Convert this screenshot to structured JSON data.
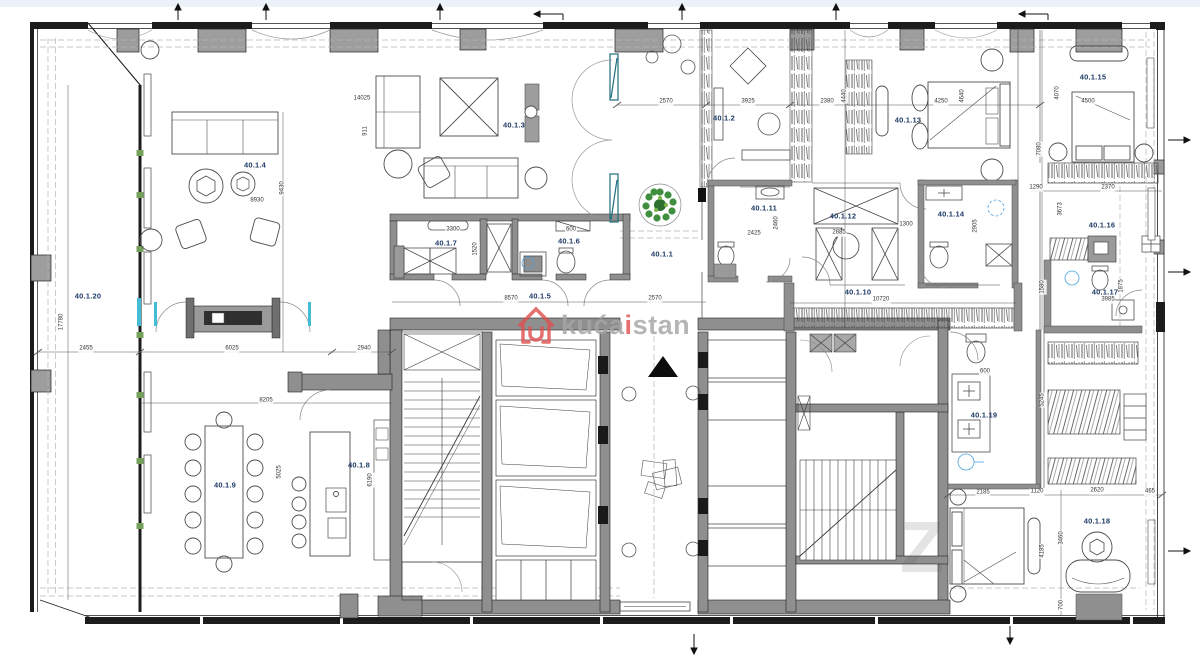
{
  "plan": {
    "type": "apartment-floor-plan",
    "unit_prefix": "40.1",
    "rooms": [
      {
        "label": "40.1.1",
        "x": 662,
        "y": 254
      },
      {
        "label": "40.1.2",
        "x": 724,
        "y": 118
      },
      {
        "label": "40.1.3",
        "x": 514,
        "y": 125
      },
      {
        "label": "40.1.4",
        "x": 255,
        "y": 165
      },
      {
        "label": "40.1.5",
        "x": 540,
        "y": 296
      },
      {
        "label": "40.1.6",
        "x": 569,
        "y": 241
      },
      {
        "label": "40.1.7",
        "x": 446,
        "y": 243
      },
      {
        "label": "40.1.8",
        "x": 359,
        "y": 465
      },
      {
        "label": "40.1.9",
        "x": 225,
        "y": 485
      },
      {
        "label": "40.1.10",
        "x": 858,
        "y": 292
      },
      {
        "label": "40.1.11",
        "x": 764,
        "y": 208
      },
      {
        "label": "40.1.12",
        "x": 843,
        "y": 216
      },
      {
        "label": "40.1.13",
        "x": 908,
        "y": 120
      },
      {
        "label": "40.1.14",
        "x": 951,
        "y": 214
      },
      {
        "label": "40.1.15",
        "x": 1093,
        "y": 77
      },
      {
        "label": "40.1.16",
        "x": 1102,
        "y": 225
      },
      {
        "label": "40.1.17",
        "x": 1105,
        "y": 292
      },
      {
        "label": "40.1.18",
        "x": 1097,
        "y": 521
      },
      {
        "label": "40.1.19",
        "x": 984,
        "y": 415
      },
      {
        "label": "40.1.20",
        "x": 88,
        "y": 296
      }
    ],
    "dimensions_mm": [
      {
        "text": "14025",
        "x": 362,
        "y": 99,
        "rot": 0
      },
      {
        "text": "911",
        "x": 366,
        "y": 131,
        "rot": 90
      },
      {
        "text": "9430",
        "x": 283,
        "y": 188,
        "rot": 90
      },
      {
        "text": "8930",
        "x": 257,
        "y": 201,
        "rot": 0
      },
      {
        "text": "17780",
        "x": 62,
        "y": 322,
        "rot": 90
      },
      {
        "text": "2455",
        "x": 86,
        "y": 349,
        "rot": 0
      },
      {
        "text": "6025",
        "x": 232,
        "y": 349,
        "rot": 0
      },
      {
        "text": "2940",
        "x": 364,
        "y": 349,
        "rot": 0
      },
      {
        "text": "8205",
        "x": 266,
        "y": 401,
        "rot": 0
      },
      {
        "text": "5025",
        "x": 280,
        "y": 472,
        "rot": 90
      },
      {
        "text": "6190",
        "x": 371,
        "y": 480,
        "rot": 90
      },
      {
        "text": "3300",
        "x": 453,
        "y": 230,
        "rot": 0
      },
      {
        "text": "600",
        "x": 571,
        "y": 230,
        "rot": 0
      },
      {
        "text": "1520",
        "x": 476,
        "y": 249,
        "rot": 90
      },
      {
        "text": "8570",
        "x": 511,
        "y": 299,
        "rot": 0
      },
      {
        "text": "2570",
        "x": 655,
        "y": 299,
        "rot": 0
      },
      {
        "text": "2570",
        "x": 666,
        "y": 102,
        "rot": 0
      },
      {
        "text": "3925",
        "x": 748,
        "y": 102,
        "rot": 0
      },
      {
        "text": "2380",
        "x": 827,
        "y": 102,
        "rot": 0
      },
      {
        "text": "4440",
        "x": 845,
        "y": 96,
        "rot": 90
      },
      {
        "text": "4250",
        "x": 941,
        "y": 102,
        "rot": 0
      },
      {
        "text": "4640",
        "x": 963,
        "y": 96,
        "rot": 90
      },
      {
        "text": "2425",
        "x": 754,
        "y": 234,
        "rot": 0
      },
      {
        "text": "2460",
        "x": 777,
        "y": 223,
        "rot": 90
      },
      {
        "text": "2885",
        "x": 839,
        "y": 233,
        "rot": 0
      },
      {
        "text": "1300",
        "x": 906,
        "y": 225,
        "rot": 0
      },
      {
        "text": "2905",
        "x": 976,
        "y": 226,
        "rot": 90
      },
      {
        "text": "10720",
        "x": 881,
        "y": 300,
        "rot": 0
      },
      {
        "text": "4070",
        "x": 1058,
        "y": 93,
        "rot": 90
      },
      {
        "text": "4500",
        "x": 1088,
        "y": 102,
        "rot": 0
      },
      {
        "text": "7080",
        "x": 1040,
        "y": 149,
        "rot": 90
      },
      {
        "text": "1290",
        "x": 1036,
        "y": 188,
        "rot": 0
      },
      {
        "text": "2370",
        "x": 1108,
        "y": 188,
        "rot": 0
      },
      {
        "text": "3673",
        "x": 1061,
        "y": 209,
        "rot": 90
      },
      {
        "text": "1580",
        "x": 1043,
        "y": 287,
        "rot": 90
      },
      {
        "text": "1875",
        "x": 1122,
        "y": 286,
        "rot": 90
      },
      {
        "text": "3985",
        "x": 1108,
        "y": 300,
        "rot": 0
      },
      {
        "text": "600",
        "x": 985,
        "y": 372,
        "rot": 0
      },
      {
        "text": "5245",
        "x": 1043,
        "y": 400,
        "rot": 90
      },
      {
        "text": "2185",
        "x": 983,
        "y": 493,
        "rot": 0
      },
      {
        "text": "1120",
        "x": 1037,
        "y": 492,
        "rot": 0
      },
      {
        "text": "2620",
        "x": 1097,
        "y": 491,
        "rot": 0
      },
      {
        "text": "465",
        "x": 1150,
        "y": 492,
        "rot": 0
      },
      {
        "text": "3460",
        "x": 1062,
        "y": 538,
        "rot": 90
      },
      {
        "text": "4185",
        "x": 1043,
        "y": 551,
        "rot": 90
      },
      {
        "text": "700",
        "x": 1062,
        "y": 605,
        "rot": 90
      }
    ]
  },
  "watermark": {
    "prefix": "kuća",
    "accent": "i",
    "suffix": "stan",
    "text_color": "#a5a5a5",
    "accent_color": "#e05252"
  },
  "ghost_watermark": "Z",
  "colors": {
    "wall_black": "#1c1c1c",
    "wall_poche_gray": "#8f8f8f",
    "column_gray": "#9d9d9d",
    "room_label_navy": "#1e3a66",
    "glass_cyan": "#45bcd6",
    "glass_teal_frame": "#1d6e7e",
    "plant_green": "#3f8f3f",
    "window_tick_green": "#74a05c",
    "fixture_blue": "#4aa3e0"
  }
}
